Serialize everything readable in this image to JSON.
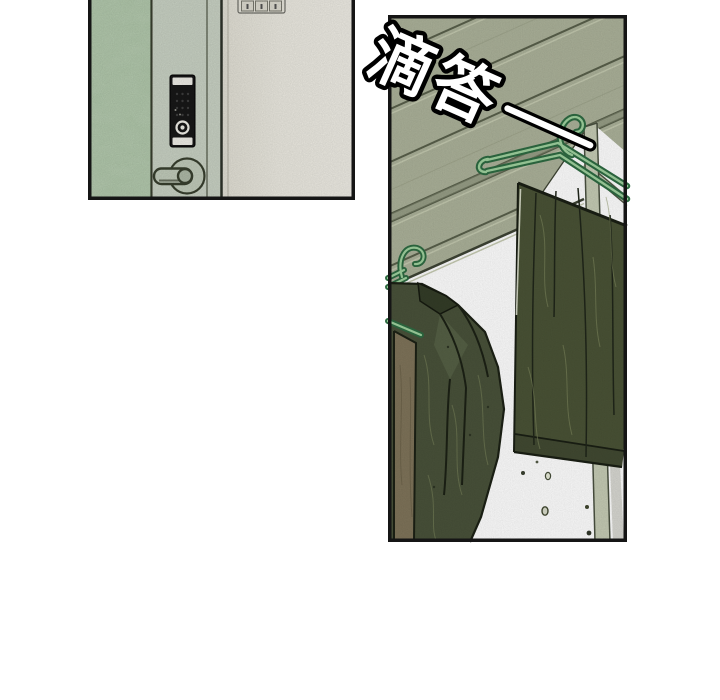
{
  "sfx": {
    "text": "滴答",
    "dash": "—",
    "fill": "#FFFFFF",
    "outline": "#000000",
    "rotation_deg": 24
  },
  "colors": {
    "page_bg": "#FFFFFF",
    "panel_border": "#151515",
    "wall_green": "#B2C9AC",
    "door_stile": "#CBD4C6",
    "door_face": "#ECEAE1",
    "keypad_black": "#181818",
    "keypad_caps": "#F2F1EA",
    "metal_sage": "#C3CDBC",
    "ceiling": "#ACB29A",
    "plank_line": "#59604B",
    "plank_highlight": "#C6CBB2",
    "post": "#C6CCB5",
    "hanger_dark": "#2E6B42",
    "hanger_light": "#9FD19E",
    "cloth_green": "#4A5336",
    "cloth_cuff": "#424A32",
    "jacket_green": "#49523A",
    "jacket_collar": "#343D28",
    "lapel_light": "#556045",
    "lining_brown": "#7F745A",
    "window_white": "#FFFFFF",
    "outline_dark": "#1C2115"
  },
  "panels": [
    {
      "id": "door",
      "objects": [
        "wall",
        "door-frame",
        "keypad-lock",
        "door-handle",
        "switch-plate"
      ]
    },
    {
      "id": "laundry",
      "objects": [
        "ceiling-planks",
        "window-light",
        "window-post",
        "wire-hanger-jacket",
        "wire-hanger-pants",
        "jacket",
        "pants",
        "water-drops"
      ]
    }
  ]
}
